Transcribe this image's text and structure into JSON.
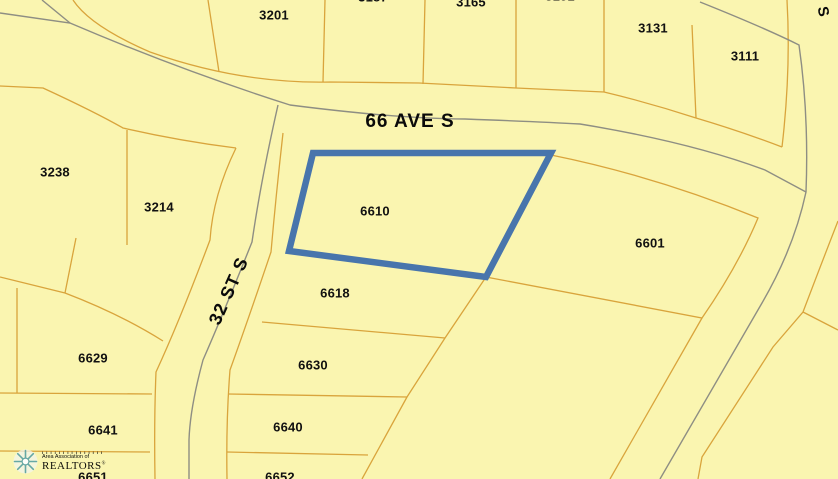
{
  "map": {
    "background_color": "#FAF5B0",
    "parcel_line_color": "#D9A43C",
    "road_line_color": "#8E8E83",
    "highlight_color": "#4875AC",
    "label_color": "#111111",
    "highlighted_parcel": "6610",
    "streets": [
      {
        "name": "66 AVE S",
        "x": 410,
        "y": 122,
        "rotation": 0,
        "size": 19
      },
      {
        "name": "32 ST S",
        "x": 229,
        "y": 291,
        "rotation": -66,
        "size": 18
      },
      {
        "name": "S",
        "x": 823,
        "y": 12,
        "rotation": 80,
        "size": 15
      }
    ],
    "parcels": [
      {
        "number": "3201",
        "x": 274,
        "y": 15
      },
      {
        "number": "3187",
        "x": 373,
        "y": -3
      },
      {
        "number": "3165",
        "x": 471,
        "y": 2
      },
      {
        "number": "3151",
        "x": 560,
        "y": -4
      },
      {
        "number": "3131",
        "x": 653,
        "y": 28
      },
      {
        "number": "3111",
        "x": 745,
        "y": 56
      },
      {
        "number": "3238",
        "x": 55,
        "y": 172
      },
      {
        "number": "3214",
        "x": 159,
        "y": 207
      },
      {
        "number": "6610",
        "x": 375,
        "y": 211,
        "highlighted": true
      },
      {
        "number": "6601",
        "x": 650,
        "y": 243
      },
      {
        "number": "6618",
        "x": 335,
        "y": 293
      },
      {
        "number": "6629",
        "x": 93,
        "y": 358
      },
      {
        "number": "6630",
        "x": 313,
        "y": 365
      },
      {
        "number": "6641",
        "x": 103,
        "y": 430
      },
      {
        "number": "6640",
        "x": 288,
        "y": 427
      },
      {
        "number": "6651",
        "x": 93,
        "y": 477
      },
      {
        "number": "6652",
        "x": 280,
        "y": 477
      }
    ]
  },
  "logo": {
    "tagline_ticks": "I I I I I I I I I I I I I I I",
    "line2": "Area Association of",
    "line3": "REALTORS",
    "registered_mark": "®",
    "text_color": "#56A2A2",
    "line2_color": "#C39B4E"
  }
}
